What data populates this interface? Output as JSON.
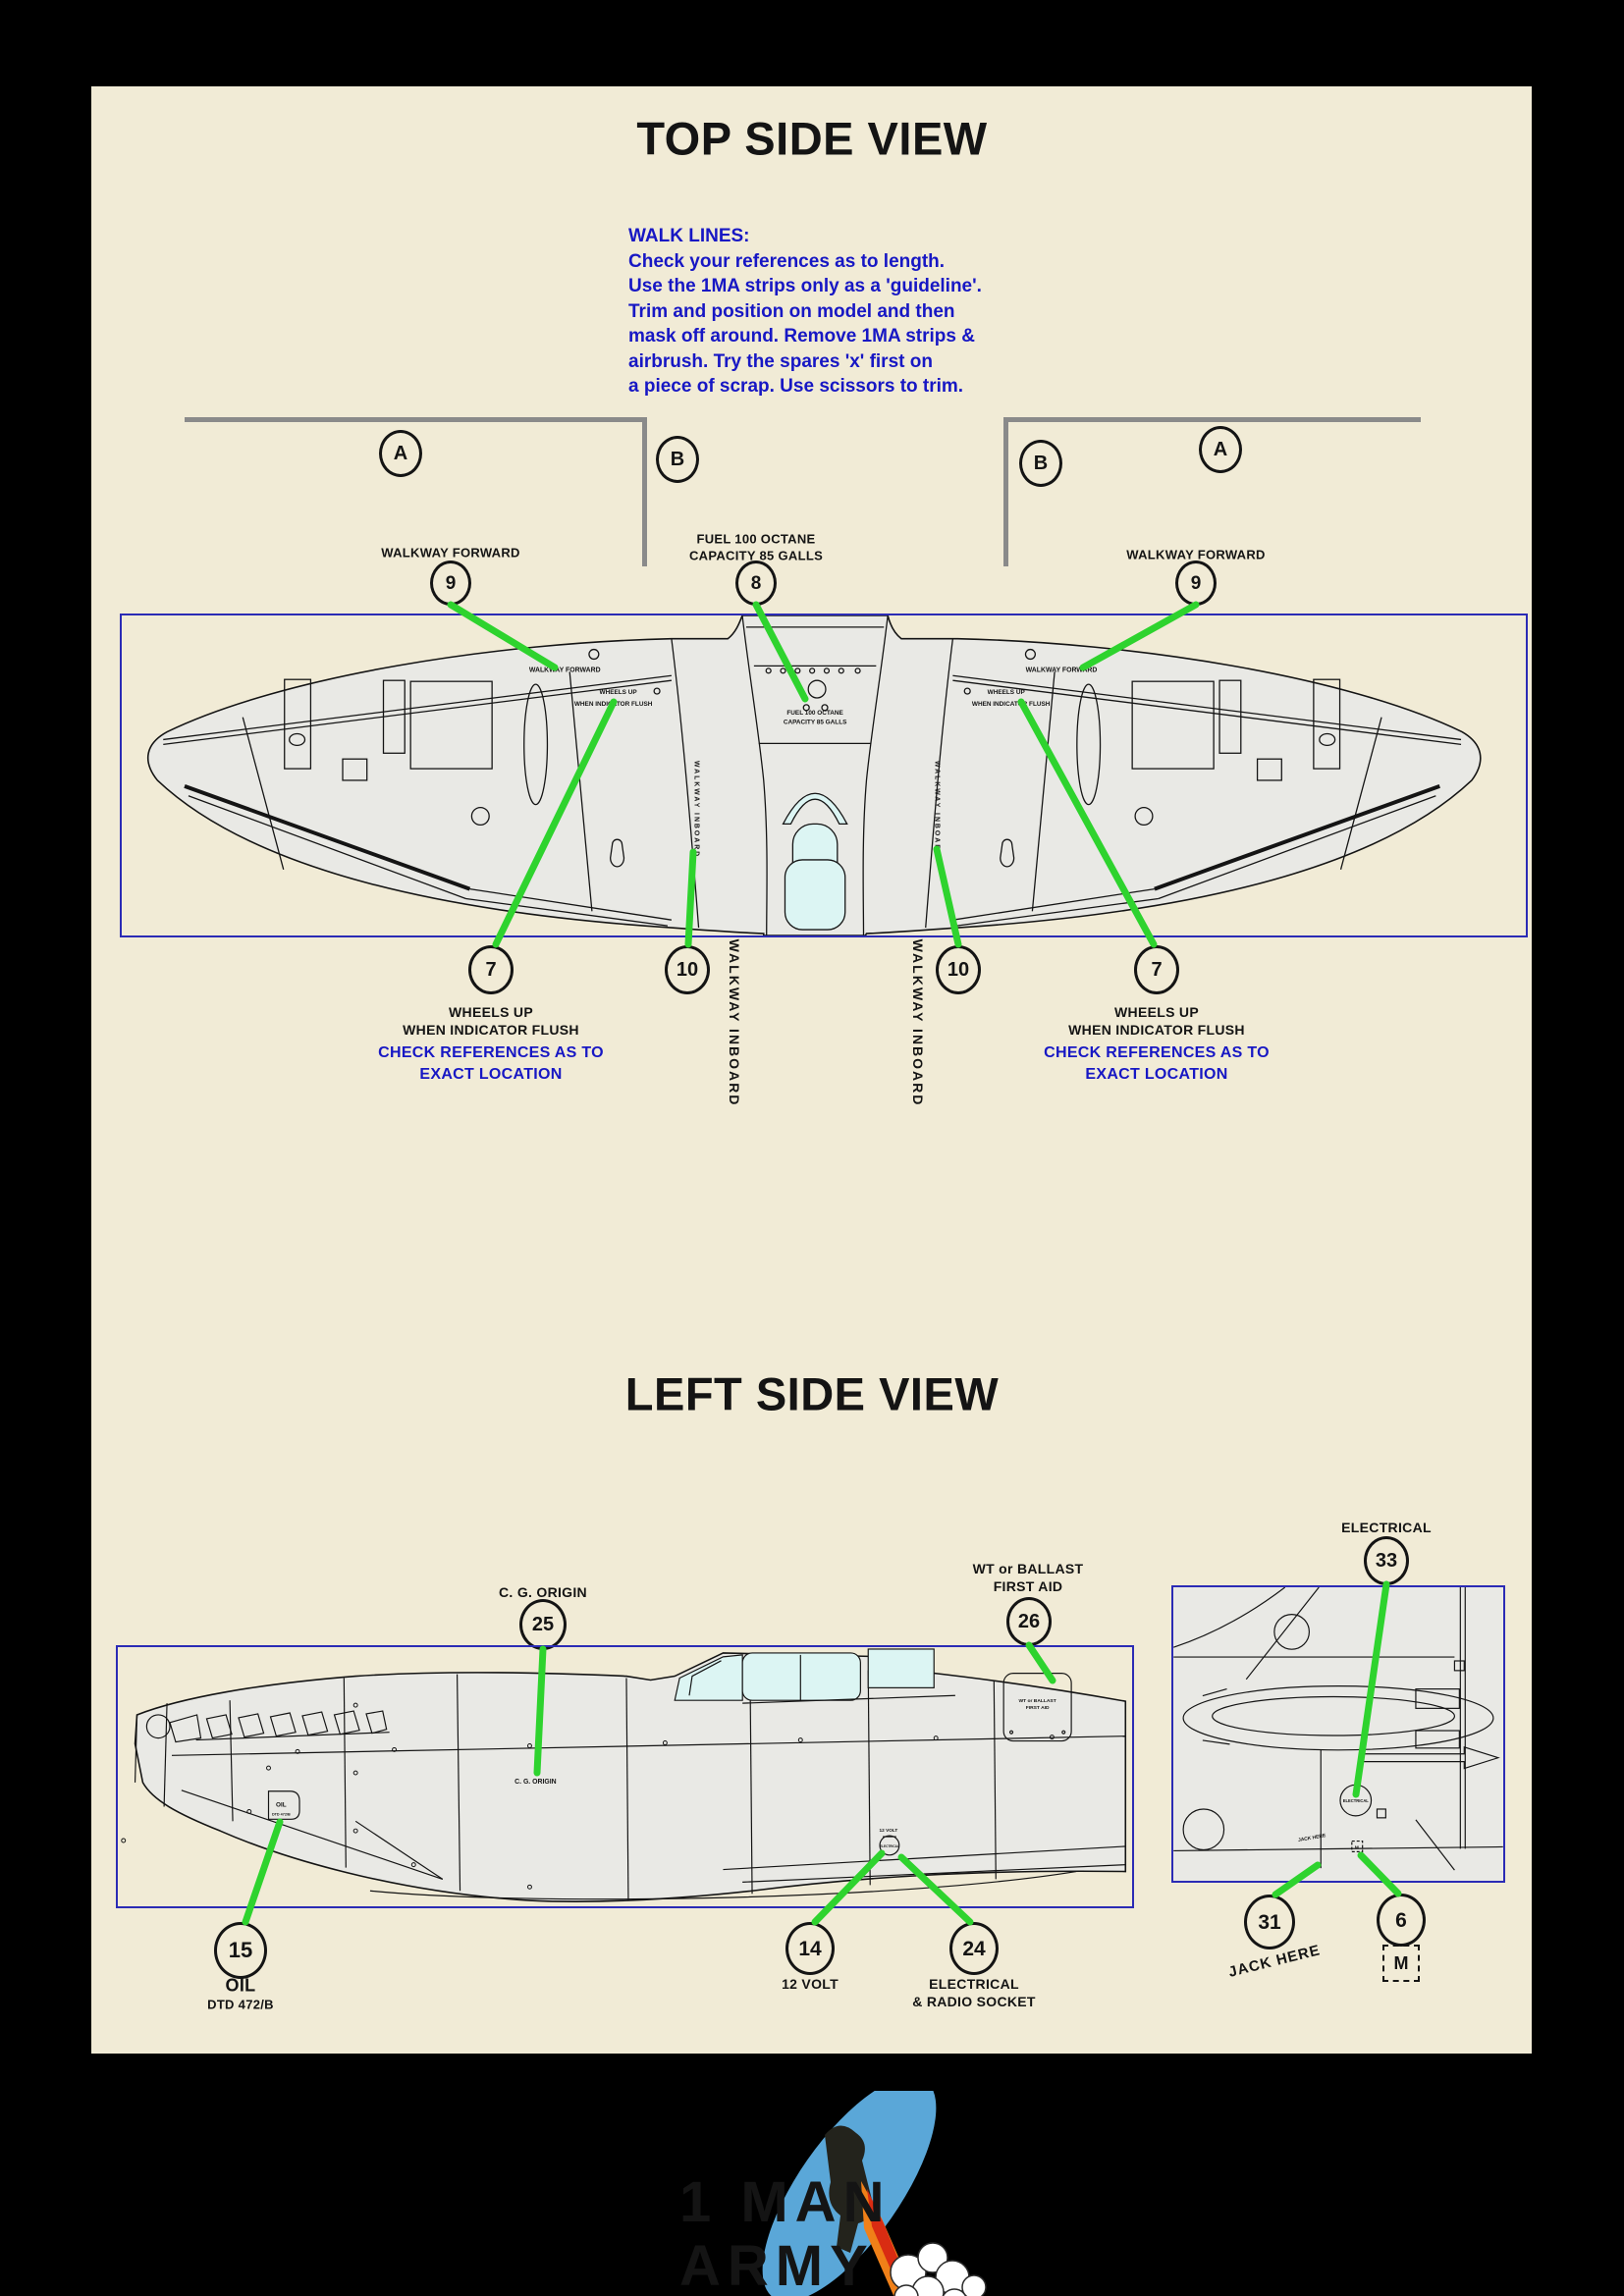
{
  "colors": {
    "paper": "#f1ebd6",
    "ink": "#141414",
    "note_blue": "#1717c4",
    "box_blue": "#2b2bb5",
    "callout_green": "#2ed32e",
    "bracket_gray": "#8a8a8a",
    "diagram_fill": "#e9e9e5",
    "canopy_cyan": "#dcf5f3",
    "logo_gold": "#e3a41d",
    "logo_blue": "#5aa7d8"
  },
  "titles": {
    "top": "TOP SIDE VIEW",
    "left": "LEFT SIDE VIEW"
  },
  "note": {
    "heading": "WALK LINES:",
    "lines": [
      "Check your references as to length.",
      "Use the 1MA strips only as a 'guideline'.",
      "Trim and position on model and then",
      "mask off around. Remove 1MA strips &",
      "airbrush. Try the spares 'x' first on",
      "a piece of scrap. Use scissors to trim."
    ]
  },
  "markers": {
    "a": "A",
    "b": "B"
  },
  "top_view": {
    "callouts": {
      "walkway_forward": "WALKWAY FORWARD",
      "fuel_line1": "FUEL 100 OCTANE",
      "fuel_line2": "CAPACITY 85 GALLS",
      "num9": "9",
      "num8": "8",
      "num7": "7",
      "num10": "10",
      "wheels_line1": "WHEELS UP",
      "wheels_line2": "WHEN INDICATOR FLUSH",
      "check_line1": "CHECK REFERENCES AS TO",
      "check_line2": "EXACT LOCATION",
      "walkway_inboard": "WALKWAY INBOARD"
    },
    "stencils": {
      "walkway_forward": "WALKWAY FORWARD",
      "wheels1": "WHEELS UP",
      "wheels2": "WHEN INDICATOR FLUSH",
      "fuel1": "FUEL 100 OCTANE",
      "fuel2": "CAPACITY 85 GALLS",
      "walkway_inboard": "WALKWAY INBOARD"
    }
  },
  "left_view": {
    "electrical": {
      "num": "33",
      "label": "ELECTRICAL"
    },
    "cg": {
      "num": "25",
      "label": "C. G. ORIGIN"
    },
    "ballast": {
      "num": "26",
      "label1": "WT or BALLAST",
      "label2": "FIRST AID"
    },
    "oil": {
      "num": "15",
      "label1": "OIL",
      "label2": "DTD 472/B"
    },
    "volt": {
      "num": "14",
      "label": "12 VOLT"
    },
    "socket": {
      "num": "24",
      "label1": "ELECTRICAL",
      "label2": "& RADIO SOCKET"
    },
    "jack": {
      "num": "31",
      "label": "JACK HERE"
    },
    "m": {
      "num": "6",
      "label": "M"
    },
    "stencils": {
      "oil1": "OIL",
      "oil2": "DTD 472/B",
      "cg": "C. G. ORIGIN",
      "ballast1": "WT or BALLAST",
      "ballast2": "FIRST AID",
      "volt": "12 VOLT",
      "electrical": "ELECTRICAL"
    }
  },
  "logo": {
    "line1": "1 MAN",
    "line2": "ARMY"
  }
}
